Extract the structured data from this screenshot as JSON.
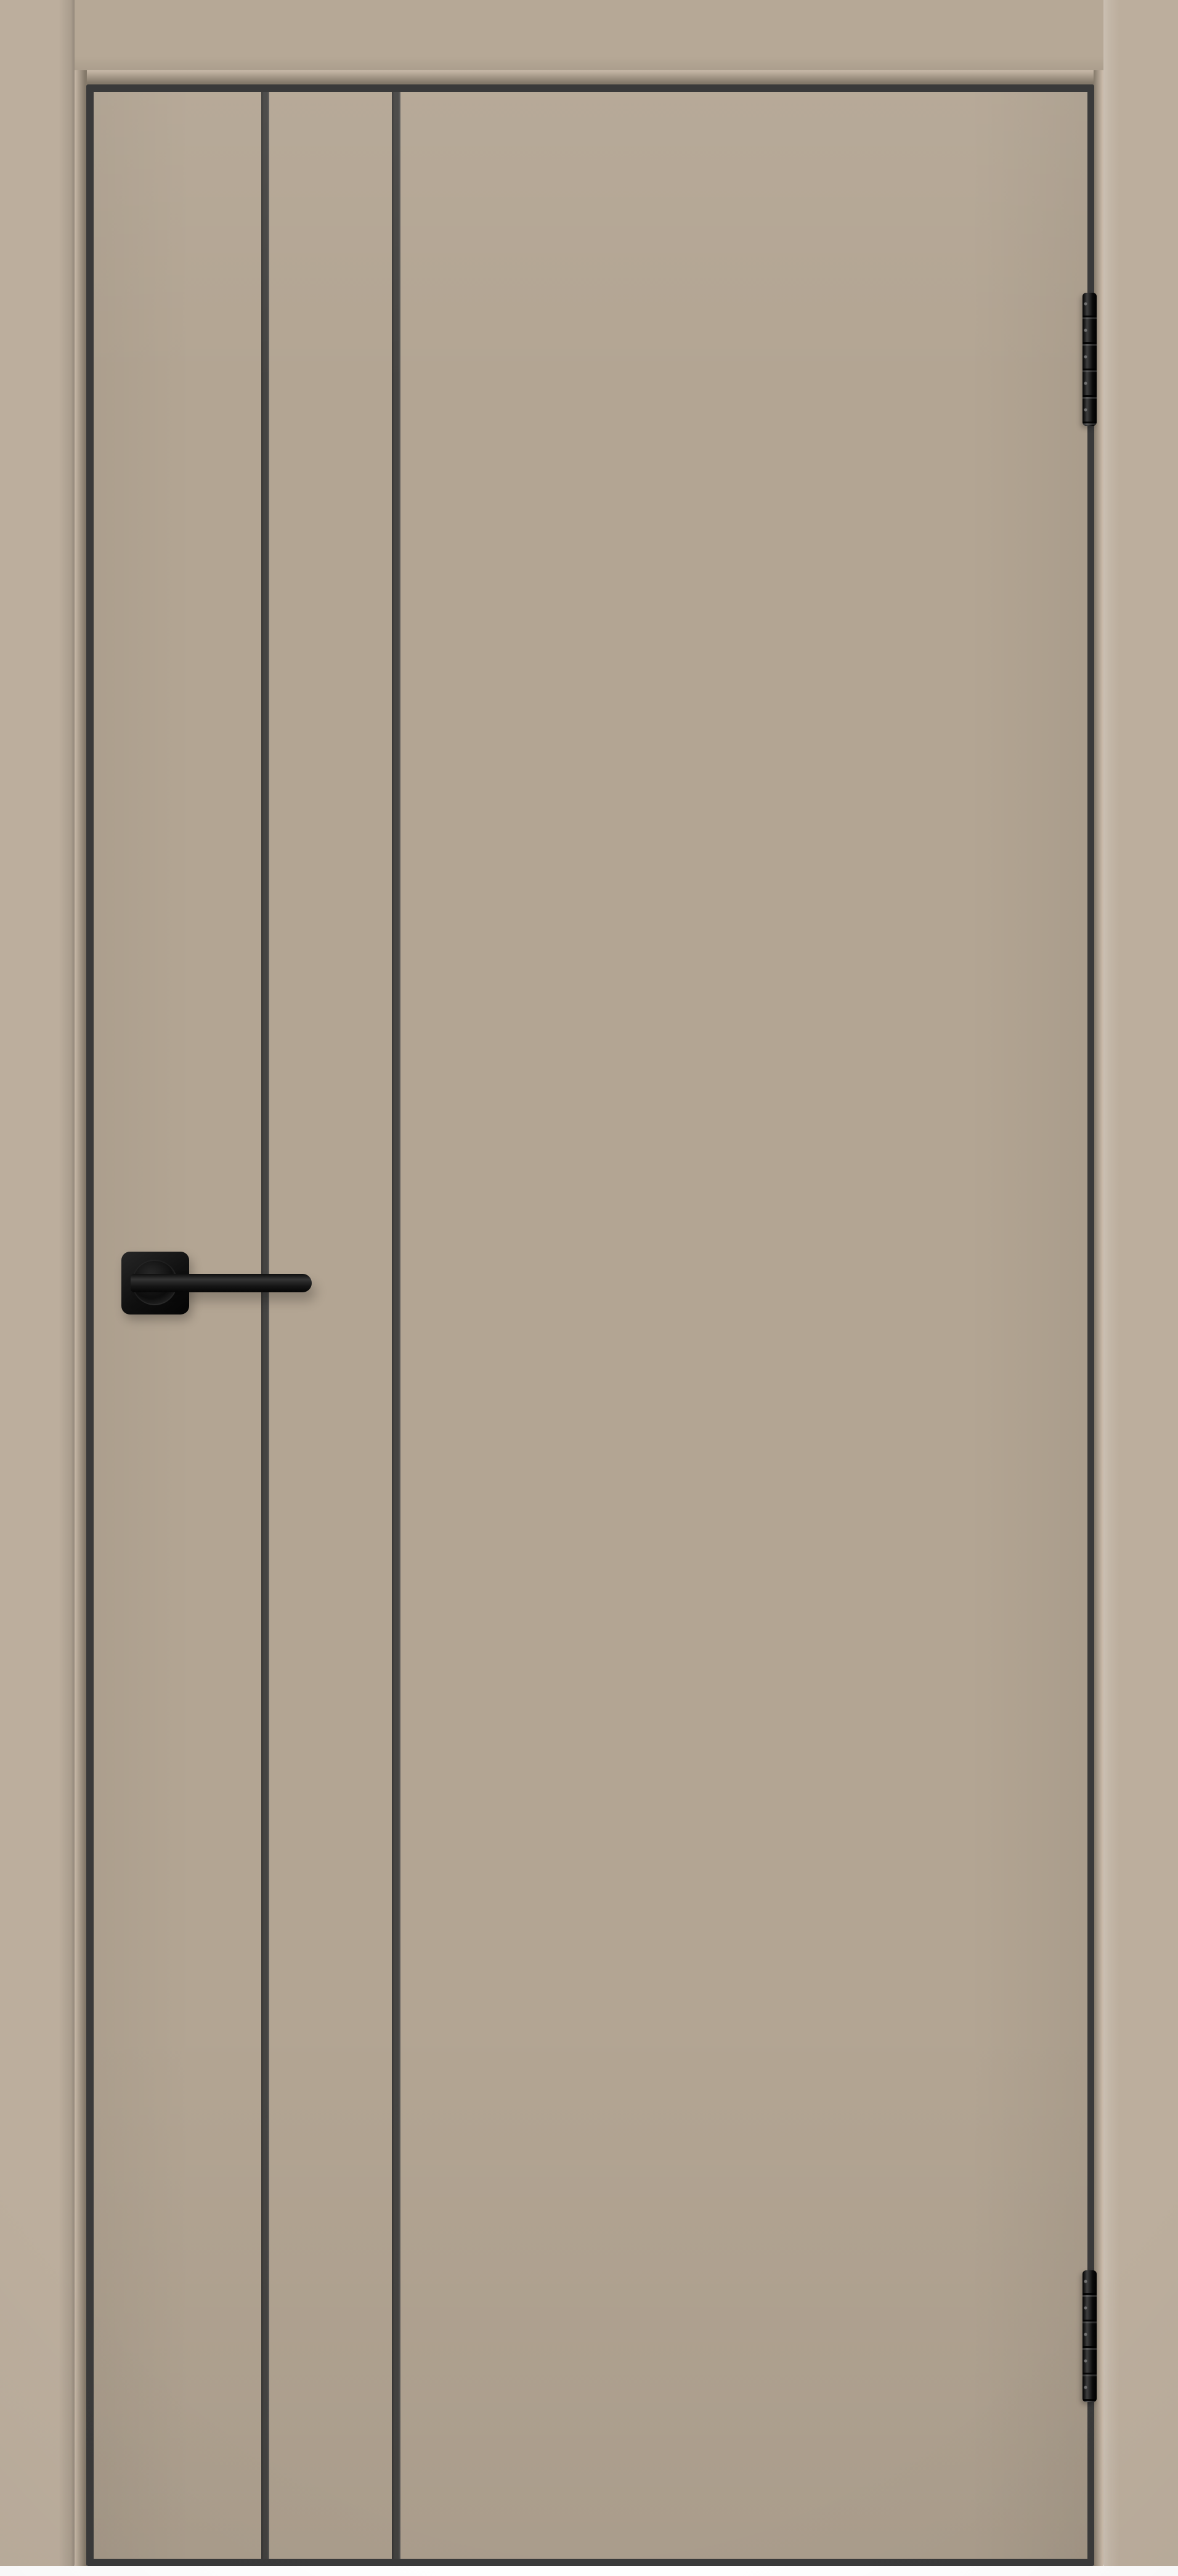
{
  "scene": {
    "type": "product-photograph",
    "subject": "Interior door leaf in a frame, warm taupe (mocha) enamel finish, contrasting black edge trim, two vertical black contour moldings on the hinge-opposite side, matte black square-rosette lever handle, two black barrel hinges on the right edge",
    "background": "white"
  },
  "colors": {
    "page_background": "#ffffff",
    "casing": "#bcae9d",
    "head_band": "#b6a896",
    "door_face": "#b3a593",
    "reveal_light": "#c8b9a8",
    "reveal_shadow": "#84796a",
    "edge_trim": "#3a3a3a",
    "groove": "#454442",
    "hardware": "#161616",
    "hardware_highlight": "#3f3f3f"
  },
  "parts": {
    "casing_left": {
      "label": "left door-frame casing"
    },
    "casing_right": {
      "label": "right door-frame casing"
    },
    "head_band": {
      "label": "top door-frame head casing"
    },
    "door_leaf": {
      "label": "door leaf with black edge trim"
    },
    "door_face": {
      "label": "flat taupe door face"
    },
    "groove_1": {
      "label": "first vertical black molding line"
    },
    "groove_2": {
      "label": "second vertical black molding line"
    },
    "hinge_top": {
      "label": "upper black barrel hinge"
    },
    "hinge_bottom": {
      "label": "lower black barrel hinge"
    },
    "rosette": {
      "label": "square black handle rosette"
    },
    "lever": {
      "label": "black door lever handle"
    }
  }
}
